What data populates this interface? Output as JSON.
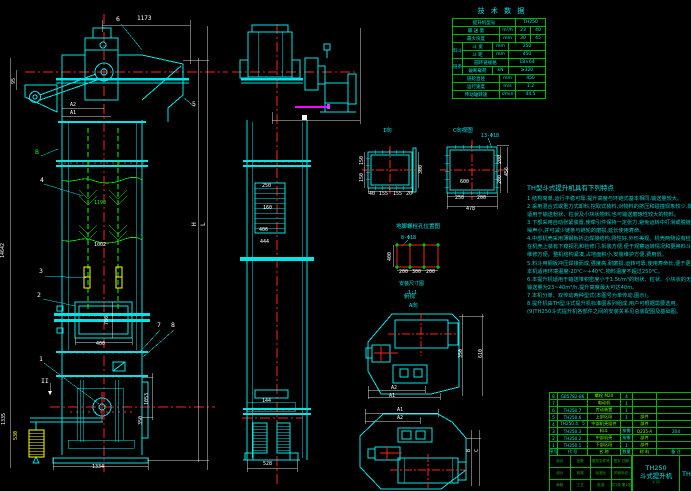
{
  "colors": {
    "line_cyan": "#00e5e5",
    "green": "#00ff00",
    "red": "#ff0000",
    "yellow": "#ffff00",
    "magenta": "#ff00ff",
    "white": "#ffffff",
    "background": "#000000"
  },
  "dims": {
    "head_width": "1173",
    "a2": "A2",
    "a1": "A1",
    "left_95": "95",
    "overall_height": "14642",
    "mid_1190": "1190",
    "mid_1002": "1002",
    "door_w": "400",
    "door_h": "780",
    "boot_w": "1334",
    "boot_left_h": "1335",
    "weight_h": "530",
    "boot_right_h": "1053",
    "boot_right_h2": "350",
    "dim_L": "L",
    "dim_H": "H",
    "side_250": "250",
    "side_160": "160",
    "side_406": "406",
    "side_444": "444",
    "side_144": "144",
    "side_528": "528",
    "i_300": "300",
    "i_150a": "150",
    "i_150b": "150",
    "i_b1": "40",
    "i_b2": "155",
    "i_b3": "155",
    "i_b4": "20",
    "c_250": "250",
    "c_200": "200",
    "c_total": "478",
    "c_r200a": "200",
    "c_r200b": "200",
    "c_r456": "456",
    "c_600": "600",
    "an_400": "400",
    "an_200a": "200",
    "an_300": "300",
    "an_200b": "200",
    "hp_350": "350",
    "hp_610": "610",
    "hp_a2": "A2",
    "hp_a1": "A1",
    "bp_a1": "A1",
    "bp_a2": "A2",
    "bp_b": "B",
    "bp_c": "C"
  },
  "balloons": {
    "b1": "1",
    "b2": "2",
    "b3": "3",
    "b4": "4",
    "b5": "5",
    "b6": "6",
    "b7": "7",
    "b8": "8",
    "bB": "B",
    "bII": "II"
  },
  "views": {
    "i_label": "I向",
    "c_label": "C向视图",
    "c_hole": "13-Φ18",
    "anchor_title": "地脚螺栓孔位置图",
    "anchor_hole": "8-Φ18",
    "anchor_note1": "安装尺寸图",
    "anchor_note2": "1:1",
    "plan1_label1": "俯视",
    "plan1_label2": "A向"
  },
  "tech": {
    "title": "技 术 数 据",
    "r1l": "提升机型号",
    "r1v": "TH250",
    "r2l": "输 送 量",
    "r2u": "m³/h",
    "r2a": "23",
    "r2b": "40",
    "r3l": "最大块度",
    "r3u": "mm",
    "r3a": "30",
    "r3b": "45",
    "g1": "料斗",
    "r4l": "斗 宽",
    "r4u": "mm",
    "r4v": "250",
    "r5l": "斗 距",
    "r5u": "mm",
    "r5v": "450",
    "g2": "链条",
    "r6l": "圆环链规格",
    "r6v": "18×64",
    "r7l": "破断载荷",
    "r7u": "kN",
    "r7v": "≥320",
    "r8l": "链轮直径",
    "r8u": "mm",
    "r8v": "450",
    "r9l": "运行速度",
    "r9u": "m/s",
    "r9v": "1.2",
    "r10l": "传动轴转速",
    "r10u": "r/min",
    "r10v": "44.5"
  },
  "notes": {
    "title": "TH型斗式提升机具有下列特点",
    "lines": [
      "1.结构简单,运行平稳可靠,提升高度与环链式基本相同,输送量较大。",
      "2.采用混合式或重力式卸料,挖取式装料,对物料的挤压和碰撞现象较少,故物料破碎率低,",
      "  适用于输送粉状、粒状及小块状物料,也可输送磨琢性较大的物料。",
      "3.下部采用自动张紧装置,使牵引件保持一定张力,避免运转中打滑或脱链,工作平稳可靠,",
      "  噪声小,并可减少链条与链轮的磨损,延长使用寿命。",
      "4.中部机壳采用薄钢板折边焊接结构,刚性好,外形美观。机壳两侧设有检视门,便于观察检修,",
      "  在机壳上装有下窥视孔和检修门,拆装方便,便于观察运转情况和更换料斗及牵引件,",
      "  维修方便。整机结构紧凑,占地面积小,安装维护方便,费用低。",
      "5.料斗用钢板冲压焊接而成,强度高,耐磨损,运转可靠,使用寿命长,便于更换。",
      "  本机适用环境温度-20℃~+40℃,物料温度不超过250℃。",
      "6.本提升机适用于输送堆积密度小于1.5t/m³的粉状、粒状、小块状的无磨琢性、半磨琢性物料,",
      "  输送量为23~40m³/h,提升高度最大可达40m。",
      "7.本机分单、双传动两种型式(本图号为单传动,图示)。",
      "8.提升机由TH型斗式提升机标准图系列组成,用户可根据需要选用。",
      "(9)TH250斗式提升机各部件之间的安装关系见总装配图及基础图。"
    ]
  },
  "bom": {
    "rows": [
      [
        "8",
        "GB5782-86",
        "螺栓 M20",
        "4",
        "",
        ""
      ],
      [
        "7",
        "",
        "电动机",
        "1",
        "",
        ""
      ],
      [
        "6",
        "TH250.7",
        "传动装置",
        "1",
        "",
        ""
      ],
      [
        "5",
        "TH250.6",
        "上部区段",
        "1",
        "部件",
        ""
      ],
      [
        "4",
        "TH250.4、5",
        "中部机壳组件",
        "",
        "部件",
        ""
      ],
      [
        "3",
        "TH250.3",
        "料斗",
        "按需",
        "Q235-A",
        "204"
      ],
      [
        "2",
        "TH250.2",
        "中部机壳",
        "按需",
        "部件",
        ""
      ],
      [
        "1",
        "TH250.1",
        "下部区段",
        "1",
        "部件",
        ""
      ]
    ],
    "header": [
      "序号",
      "代 号",
      "名 称",
      "数量",
      "材 料",
      "备 注"
    ]
  },
  "title_block": {
    "left_rows": [
      [
        "标记",
        "处数",
        "更改文件号",
        "签字 日期"
      ],
      [
        "设计",
        "校核",
        "标准化",
        "阶段标记"
      ],
      [
        "审核",
        "工艺",
        "批准",
        "共1张 第1张"
      ]
    ],
    "model": "TH250",
    "product": "斗式提升机",
    "scale": "1:25",
    "drawing_no": "TH250"
  }
}
